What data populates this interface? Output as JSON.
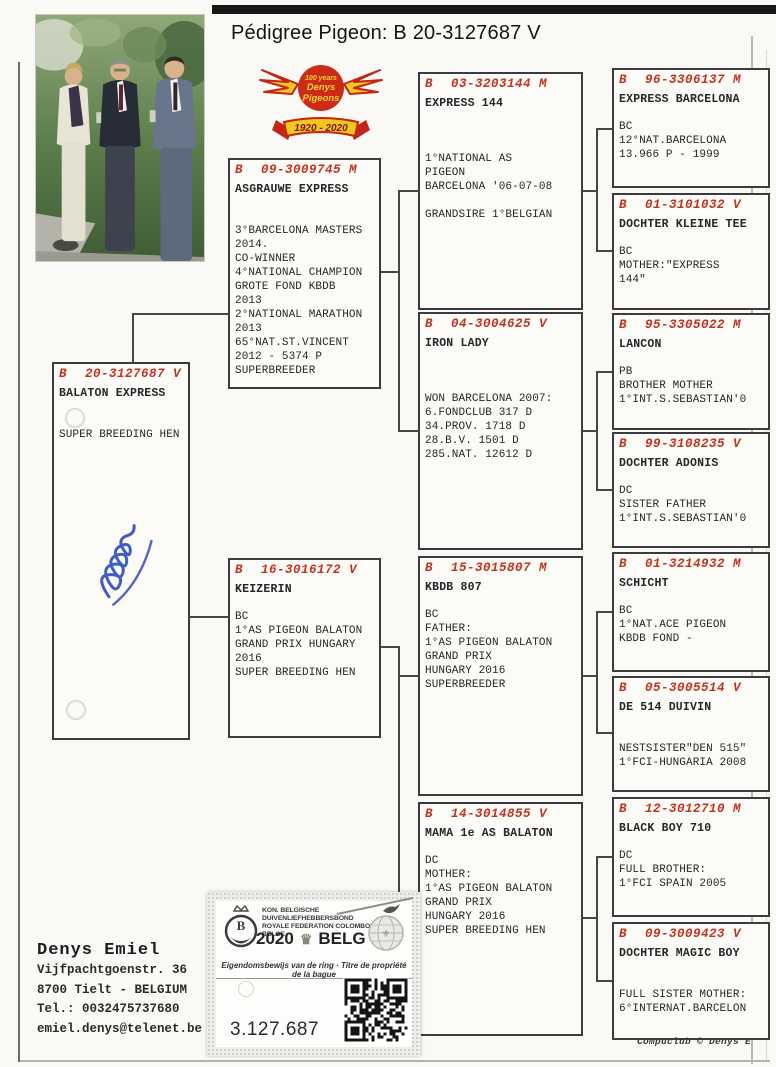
{
  "title": "Pédigree Pigeon: B   20-3127687 V",
  "logo": {
    "line1": "100 years",
    "line2": "Denys",
    "line3": "Pigeons",
    "banner": "1920 - 2020"
  },
  "boxes": [
    {
      "country": "B",
      "ring": "20-3127687 V",
      "name": "BALATON EXPRESS",
      "body": "\n\nSUPER BREEDING HEN"
    },
    {
      "country": "B",
      "ring": "09-3009745 M",
      "name": "ASGRAUWE EXPRESS",
      "body": "\n\n3°BARCELONA MASTERS\n  2014.\nCO-WINNER\n4°NATIONAL CHAMPION\nGROTE FOND KBDB\n2013\n2°NATIONAL MARATHON\n   2013\n65°NAT.ST.VINCENT\n   2012 - 5374 P\nSUPERBREEDER"
    },
    {
      "country": "B",
      "ring": "16-3016172 V",
      "name": "KEIZERIN",
      "body": "\nBC\n1°AS PIGEON BALATON\nGRAND PRIX HUNGARY\n2016\nSUPER BREEDING HEN"
    },
    {
      "country": "B",
      "ring": "03-3203144 M",
      "name": "EXPRESS 144",
      "body": "\n\n\n1°NATIONAL AS\nPIGEON\nBARCELONA '06-07-08\n\nGRANDSIRE 1°BELGIAN"
    },
    {
      "country": "B",
      "ring": "04-3004625 V",
      "name": "IRON LADY",
      "body": "\n\n\nWON BARCELONA 2007:\n6.FONDCLUB 317 D\n34.PROV. 1718 D\n28.B.V. 1501 D\n285.NAT. 12612 D"
    },
    {
      "country": "B",
      "ring": "15-3015807 M",
      "name": "KBDB 807",
      "body": "\nBC\nFATHER:\n1°AS PIGEON BALATON\n   GRAND PRIX\nHUNGARY   2016\nSUPERBREEDER"
    },
    {
      "country": "B",
      "ring": "14-3014855 V",
      "name": "MAMA 1e AS BALATON",
      "body": "\nDC\nMOTHER:\n1°AS PIGEON BALATON\n   GRAND PRIX\nHUNGARY   2016\nSUPER BREEDING HEN"
    },
    {
      "country": "B",
      "ring": "96-3306137 M",
      "name": "EXPRESS BARCELONA",
      "body": "\nBC\n12°NAT.BARCELONA\n   13.966 P - 1999"
    },
    {
      "country": "B",
      "ring": "01-3101032 V",
      "name": "DOCHTER KLEINE TEE",
      "body": "\nBC\nMOTHER:\"EXPRESS\n144\""
    },
    {
      "country": "B",
      "ring": "95-3305022 M",
      "name": "LANCON",
      "body": "\nPB\nBROTHER MOTHER\n1°INT.S.SEBASTIAN'0"
    },
    {
      "country": "B",
      "ring": "99-3108235 V",
      "name": "DOCHTER ADONIS",
      "body": "\nDC\nSISTER FATHER\n1°INT.S.SEBASTIAN'0"
    },
    {
      "country": "B",
      "ring": "01-3214932 M",
      "name": "SCHICHT",
      "body": "\nBC\n1°NAT.ACE PIGEON\n  KBDB FOND   -"
    },
    {
      "country": "B",
      "ring": "05-3005514 V",
      "name": "DE 514 DUIVIN",
      "body": "\n\nNESTSISTER\"DEN 515\"\n1°FCI-HUNGARIA 2008"
    },
    {
      "country": "B",
      "ring": "12-3012710 M",
      "name": "BLACK BOY 710",
      "body": "\nDC\nFULL BROTHER:\n1°FCI SPAIN 2005"
    },
    {
      "country": "B",
      "ring": "09-3009423 V",
      "name": "DOCHTER MAGIC BOY",
      "body": "\n\nFULL SISTER MOTHER:\n6°INTERNAT.BARCELON"
    }
  ],
  "ring_label": {
    "federation_line1": "KON. BELGISCHE DUIVENLIEFHEBBERSBOND",
    "federation_line2": "ROYALE FEDERATION COLOMBOPHILE BELGE",
    "year": "2020",
    "country": "BELG",
    "subtitle": "Eigendomsbewijs van de ring · Titre de propriété de la bague",
    "ring_number": "3.127.687",
    "emblem_letter": "B"
  },
  "owner": {
    "name": "Denys Emiel",
    "address1": "Vijfpachtgoenstr. 36",
    "address2": "8700  Tielt - BELGIUM",
    "phone": "Tel.: 0032475737680",
    "email": "emiel.denys@telenet.be"
  },
  "footer": "Compuclub © Denys E",
  "colors": {
    "ring_red": "#c0331f",
    "ink": "#26262b",
    "signature_blue": "#2b4db8"
  }
}
